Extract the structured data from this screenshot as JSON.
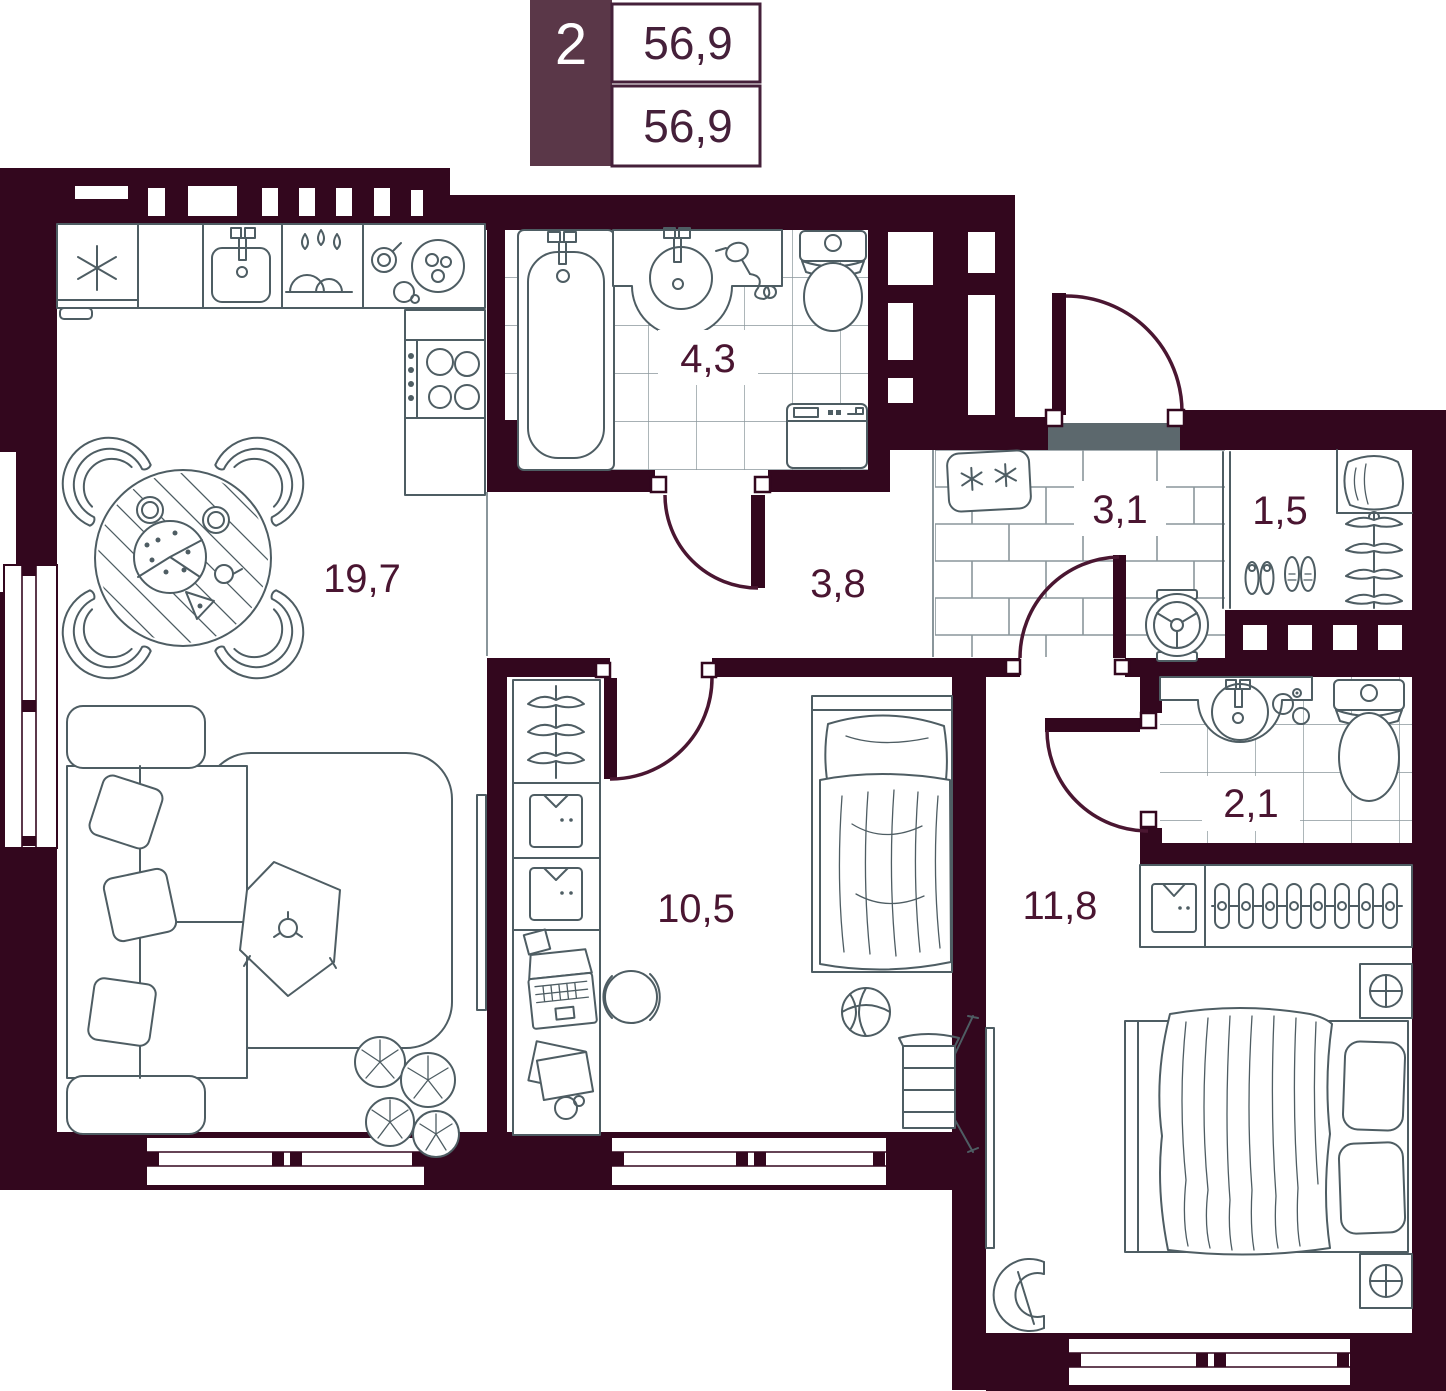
{
  "plan": {
    "type": "apartment-floor-plan",
    "badge": {
      "rooms_count": "2",
      "total_area": "56,9",
      "living_area": "56,9"
    },
    "room_labels": {
      "living_kitchen": "19,7",
      "bathroom": "4,3",
      "corridor": "3,8",
      "hallway": "3,1",
      "closet": "1,5",
      "wc": "2,1",
      "kids_room": "10,5",
      "bedroom": "11,8"
    },
    "furniture": [
      "fridge",
      "kitchen-sink",
      "dish-rack",
      "food-plates",
      "stove",
      "dining-table",
      "dining-chairs",
      "pizza",
      "corner-sofa",
      "pillows",
      "coffee-table",
      "rug",
      "plant",
      "tv-panel-living",
      "bathtub",
      "washbasin",
      "hairdryer",
      "toilet",
      "washing-machine",
      "entry-door",
      "doormat",
      "wheel",
      "shoes",
      "coat-rack",
      "jacket",
      "sliding-wardrobe-door",
      "kids-wardrobe",
      "desk",
      "laptop",
      "desk-chair",
      "single-bed",
      "basketball",
      "folding-chair",
      "bedroom-wardrobe",
      "hangers",
      "double-bed",
      "nightstand-lamps",
      "armchair",
      "tv-panel-bedroom"
    ],
    "colors": {
      "wall": "#33071e",
      "badge_bg": "#5a3748",
      "numbers": "#45203a",
      "room_label": "#4a1531",
      "furniture_line": "#4e5d63",
      "grid_line": "#8a969b",
      "door_arc": "#4a1631",
      "threshold": "#5c686d",
      "background": "#ffffff"
    }
  }
}
